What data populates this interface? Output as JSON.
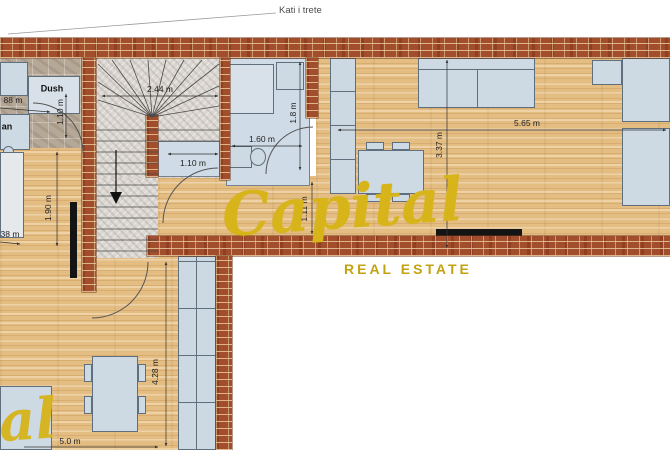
{
  "title": "Kati i trete",
  "watermark": {
    "brand": "Capital",
    "tagline": "REAL ESTATE",
    "partial_brand": "Capital",
    "gold": "#d6b41a"
  },
  "labels": {
    "shower": "Dush",
    "sink_partial": "an"
  },
  "dimensions": {
    "stair_width": "2.44 m",
    "stair_landing": "1.10 m",
    "bath1_depth": "1.10 m",
    "bath2_width": "1.60 m",
    "bath2_depth": "1.8 m",
    "passage": "1.11 m",
    "living_depth": "3.37 m",
    "living_width": "5.65 m",
    "left_room_width": "1.90 m",
    "lower_room_height": "4.28 m",
    "partial_left_top": "88 m",
    "partial_left_mid": "38 m",
    "partial_bottom": "5.0 m"
  },
  "colors": {
    "brick_wall": "#a24e2c",
    "wood_floor": "#e4bd83",
    "stone_stairs": "#dbd7d2",
    "fixture_blue": "#cdd9e3",
    "watermark_gold": "#d6b41a"
  }
}
